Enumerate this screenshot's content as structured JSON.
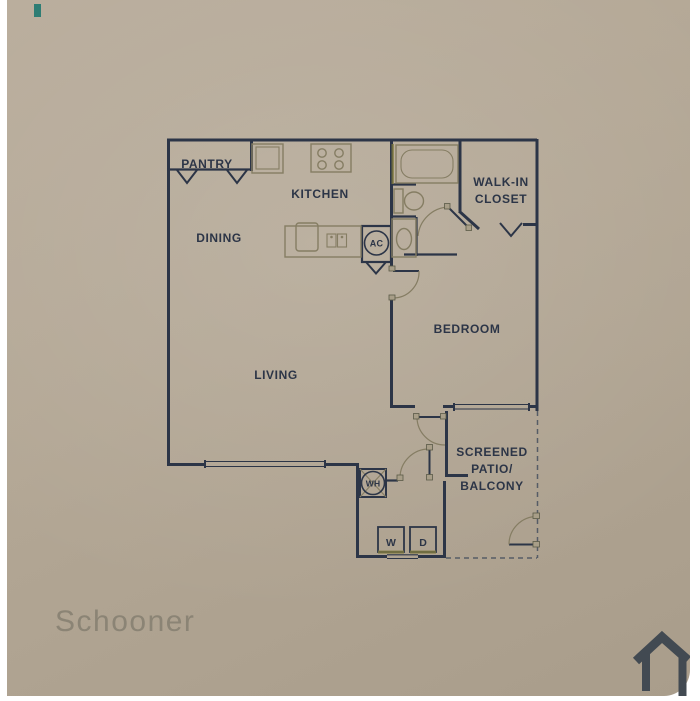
{
  "title": {
    "name": "Schooner"
  },
  "floorplan": {
    "rooms": {
      "pantry": "PANTRY",
      "kitchen": "KITCHEN",
      "dining": "DINING",
      "living": "LIVING",
      "bedroom": "BEDROOM",
      "closet1": "WALK-IN",
      "closet2": "CLOSET",
      "patio1": "SCREENED",
      "patio2": "PATIO/",
      "patio3": "BALCONY"
    },
    "labels": {
      "ac": "AC",
      "wh": "WH",
      "washer": "W",
      "dryer": "D"
    }
  },
  "colors": {
    "background": "#b3a795",
    "wall": "#2c3547",
    "fixture": "#857d63",
    "title_text": "#8b8475",
    "house_icon": "#424a52",
    "teal_mark": "#2e7d74",
    "page": "#ffffff"
  }
}
